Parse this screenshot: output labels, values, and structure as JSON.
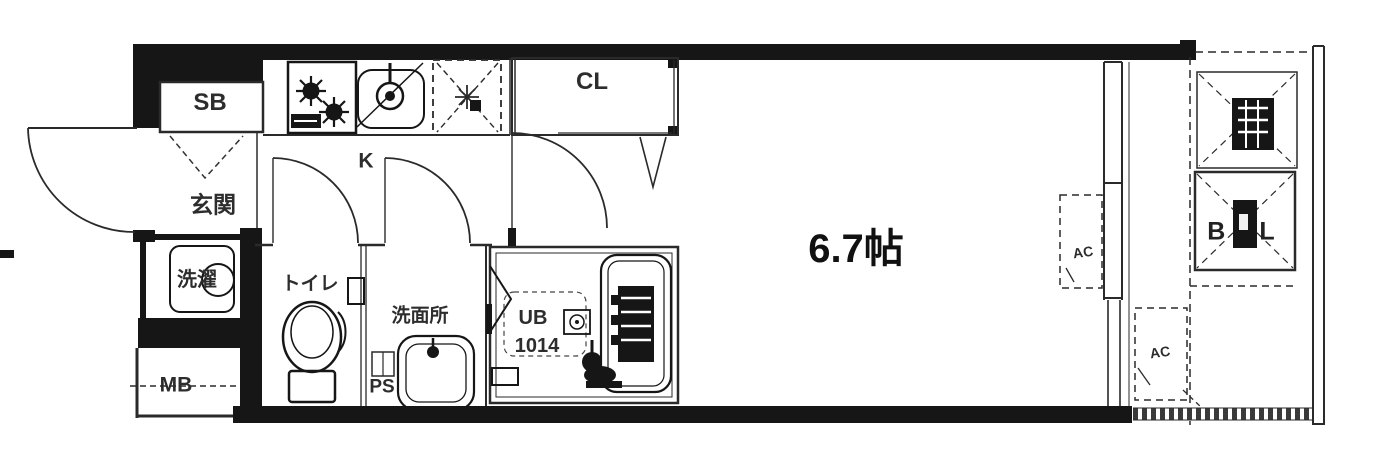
{
  "floorplan": {
    "labels": {
      "shoe_box": "SB",
      "entrance": "玄関",
      "kitchen": "K",
      "closet": "CL",
      "laundry": "洗濯",
      "meter_box": "MB",
      "toilet": "トイレ",
      "washroom": "洗面所",
      "pipe_space": "PS",
      "unit_bath": "UB",
      "unit_bath_size": "1014",
      "main_room_size": "6.7帖",
      "ac_indoor": "AC",
      "ac_outdoor": "AC",
      "balcony": "BAL"
    },
    "colors": {
      "wall": "#161616",
      "line": "#2a2a2a",
      "background": "#ffffff"
    }
  }
}
